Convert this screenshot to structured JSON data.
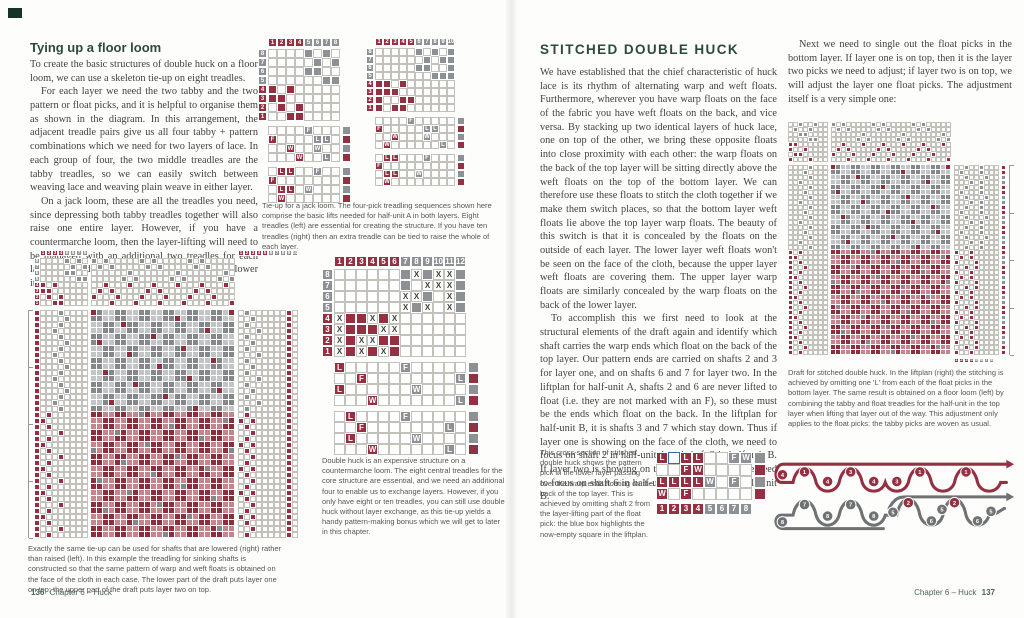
{
  "colors": {
    "accent_red": "#943041",
    "accent_gray": "#8d9194",
    "heading_green": "#2c4a3b",
    "highlight_blue": "#2f6cb0"
  },
  "left_page": {
    "heading": "Tying up a floor loom",
    "paragraphs": [
      "To create the basic structures of double huck on a floor loom, we can use a skeleton tie-up on eight treadles.",
      "For each layer we need the two tabby and the two pattern or float picks, and it is helpful to organise them as shown in the diagram. In this arrangement, the adjacent treadle pairs give us all four tabby + pattern combinations which we need for two layers of lace. In each group of four, the two middle treadles are the tabby treadles, so we can easily switch between weaving lace and weaving plain weave in either layer.",
      "On a jack loom, these are all the treadles you need, since depressing both tabby treadles together will also raise one entire layer. However, if you have a countermarche loom, then the layer-lifting will need to be managed with an additional two treadles for each layer: one tied to raise the layer and one tied to lower it."
    ],
    "caption_tieup": "Tie-up for a jack loom. The four-pick treadling sequences shown here comprise the basic lifts needed for half-unit A in both layers. Eight treadles (left) are essential for creating the structure. If you have ten treadles (right) then an extra treadle can be tied to raise the whole of each layer.",
    "caption_countermarche": "Double huck is an expensive structure on a countermarche loom. The eight central treadles for the core structure are essential, and we need an additional four to enable us to exchange layers. However, if you only have eight or ten treadles, you can still use double huck without layer exchange, as this tie-up yields a handy pattern-making bonus which we will get to later in this chapter.",
    "caption_bottom": "Exactly the same tie-up can be used for shafts that are lowered (right) rather than raised (left). In this example the treadling for sinking shafts is constructed so that the same pattern of warp and weft floats is obtained on the face of the cloth in each case. The lower part of the draft puts layer one on top; the upper part of the draft puts layer two on top.",
    "footer": {
      "page_num": "136",
      "chapter": "Chapter 6 – Huck"
    }
  },
  "right_page": {
    "heading": "STITCHED DOUBLE HUCK",
    "paragraphs": [
      "We have established that the chief characteristic of huck lace is its rhythm of alternating warp and weft floats. Furthermore, wherever you have warp floats on the face of the fabric you have weft floats on the back, and vice versa. By stacking up two identical layers of huck lace, one on top of the other, we bring these opposite floats into close proximity with each other: the warp floats on the back of the top layer will be sitting directly above the weft floats on the top of the bottom layer. We can therefore use these floats to stitch the cloth together if we make them switch places, so that the bottom layer weft floats lie above the top layer warp floats. The beauty of this switch is that it is concealed by the floats on the outside of each layer. The lower layer weft floats won't be seen on the face of the cloth, because the upper layer weft floats are covering them. The upper layer warp floats are similarly concealed by the warp floats on the back of the lower layer.",
      "To accomplish this we first need to look at the structural elements of the draft again and identify which shaft carries the warp ends which float on the back of the top layer. Our pattern ends are carried on shafts 2 and 3 for layer one, and on shafts 6 and 7 for layer two. In the liftplan for half-unit A, shafts 2 and 6 are never lifted to float (i.e. they are not marked with an F), so these must be the ends which float on the back. In the liftplan for half-unit B, it is shafts 3 and 7 which stay down. Thus if layer one is showing on the face of the cloth, we need to focus on shaft 2 in half-unit A and shaft 3 in half-unit B. If layer two is showing on the face of the cloth, we need to focus on shaft 6 in half-unit A and shaft 7 in half-unit B."
    ],
    "col2_paragraph": "Next we need to single out the float picks in the bottom layer. If layer one is on top, then it is the layer two picks we need to adjust; if layer two is on top, we will adjust the layer one float picks. The adjustment itself is a very simple one:",
    "caption_draft": "Draft for stitched double huck. In the liftplan (right) the stitching is achieved by omitting one 'L' from each of the float picks in the bottom layer. The same result is obtained on a floor loom (left) by combining the tabby and float treadles for the half-unit in the top layer when lifting that layer out of the way. This adjustment only applies to the float picks: the tabby picks are woven as usual.",
    "caption_cross_section": "This cross-section of stitched double huck shows the pattern pick in the lower layer passing over the warp ends floating on the back of the top layer. This is achieved by omitting shaft 2 from the layer-lifting part of the float pick: the blue box highlights the now-empty square in the liftplan.",
    "footer": {
      "chapter": "Chapter 6 – Huck",
      "page_num": "137"
    }
  },
  "diagrams": {
    "jack8": {
      "cell": 9,
      "cols": 8,
      "numrow": {
        "labels": [
          "1",
          "2",
          "3",
          "4",
          "5",
          "6",
          "7",
          "8"
        ],
        "colors": "rrrrgggg"
      },
      "shaftcol": {
        "labels": [
          "8",
          "7",
          "6",
          "5",
          "4",
          "3",
          "2",
          "1"
        ],
        "colors": "ggggrrrr"
      },
      "tieup": {
        "rows": [
          "....g.g.",
          ".....g.g",
          "....gg..",
          "......gg",
          "r.r.....",
          "rr......",
          ".r.r....",
          "..rr...."
        ]
      },
      "liftplanA": {
        "rows": [
          "....f...",
          "F....ll.",
          "..W..w..",
          "...W..l."
        ],
        "side": "grgr"
      },
      "liftplanB": {
        "rows": [
          ".LL..f..",
          "F.......",
          ".LL.w...",
          ".W......"
        ],
        "side": "grgr"
      }
    },
    "jack10": {
      "cell": 8,
      "cols": 10,
      "numrow": {
        "labels": [
          "1",
          "2",
          "3",
          "4",
          "5",
          "6",
          "7",
          "8",
          "9",
          "10"
        ],
        "colors": "rrrrrggggg"
      },
      "shaftcol": {
        "labels": [
          "8",
          "7",
          "6",
          "5",
          "4",
          "3",
          "2",
          "1"
        ],
        "colors": "ggggrrrr"
      },
      "tieup": {
        "rows": [
          ".....g.g.g",
          "......g.gg",
          ".....gg..g",
          ".......ggg",
          "rr.r......",
          "rrr.......",
          "r..rr.....",
          "r.rr......"
        ]
      },
      "liftplanA": {
        "rows": [
          "....f.....",
          "F.....ll..",
          "..W...w...",
          ".W......l."
        ],
        "side": "grgr"
      },
      "liftplanB": {
        "rows": [
          ".LL...f...",
          "F.........",
          ".LL..w....",
          ".W........"
        ],
        "side": "grgr"
      }
    },
    "big_left": {
      "cell": 6,
      "numrow": {
        "labels": [
          "1",
          "2",
          "3",
          "4",
          "5",
          "6",
          "7",
          "8"
        ],
        "colors": "rrrrgggg"
      },
      "shaftcol": {
        "labels": [
          "8",
          "7",
          "6",
          "5",
          "4",
          "3",
          "2",
          "1"
        ],
        "colors": "ggggrrrr"
      },
      "tieup": {
        "rows": [
          "....g.g.",
          ".....g.g",
          "....gg..",
          "......gg",
          "r.r.....",
          "rr......",
          ".r.r....",
          "..rr...."
        ]
      },
      "threading": {
        "rows": [
          "g.g.....",
          ".g.g....",
          "......g.",
          ".....g.g",
          "..r...r.",
          ".r.r....",
          "r...r...",
          "...r...r"
        ],
        "repeatX": 3
      },
      "treadling": {
        "sections": [
          {
            "rows": 17,
            "cycle": [
              "r...g....",
              "r....g...",
              "r...g....",
              "r..g....."
            ]
          },
          {
            "rows": 21,
            "cycle": [
              "r.r......",
              "rr.......",
              "r.r......",
              "r...r...."
            ]
          }
        ]
      },
      "drawdown": {
        "cols": 24,
        "cell": 5,
        "sections": [
          {
            "rows": 17,
            "dark": "#84888b",
            "light": "#c2c5c6",
            "accent": "#8e2d3c"
          },
          {
            "rows": 21,
            "dark": "#8e2d3c",
            "light": "#c4858e",
            "accent": "#84888b"
          }
        ]
      },
      "right_numrow": {
        "labels": [
          "1",
          "2",
          "3",
          "4",
          "5",
          "6",
          "7",
          "8",
          "9",
          "10"
        ],
        "colors": "rrrrrggggg"
      },
      "right_grid": {
        "sections": [
          {
            "rows": 17,
            "cycle": [
              ".g......r.",
              "..g.....r.",
              ".g......r.",
              "...g....r."
            ]
          },
          {
            "rows": 21,
            "cycle": [
              ".r......r.",
              "r.r.....r.",
              ".r......r.",
              "..r.....r."
            ]
          }
        ]
      }
    },
    "countermarche12": {
      "cell": 11,
      "numrow": {
        "labels": [
          "1",
          "2",
          "3",
          "4",
          "5",
          "6",
          "7",
          "8",
          "9",
          "10",
          "11",
          "12"
        ],
        "colors": "rrrrrrgggggg"
      },
      "shaftcol": {
        "labels": [
          "8",
          "7",
          "6",
          "5",
          "4",
          "3",
          "2",
          "1"
        ],
        "colors": "ggggrrrr"
      },
      "tieup": {
        "rows": [
          "......gxgxxg",
          "......g.xxxg",
          "......xxg.xg",
          "......xgx.xg",
          "xrrxrx......",
          "xrrrxx......",
          "xrxxrr......",
          "xrxrxr......"
        ]
      },
      "liftplanA": {
        "rows": [
          "L.....f.....",
          "..F........l",
          "L......w....",
          "...W.......l"
        ],
        "side": "grgr"
      },
      "liftplanB": {
        "rows": [
          ".L....f.....",
          "..F.......l.",
          ".L.....w....",
          "...W......l."
        ],
        "side": "grgr"
      }
    },
    "big_right": {
      "cell": 5,
      "tieup": {
        "rows": [
          "..g..g..",
          ".g..g...",
          "..gg....",
          "....gg..",
          "rr......",
          "r..r....",
          ".rr.....",
          "r...r..."
        ]
      },
      "threading": {
        "rows": [
          "g.g.....",
          ".g.g....",
          "......g.",
          ".....g.g",
          "..r...r.",
          ".r.r....",
          "r...r...",
          "...r...r"
        ],
        "repeatX": 3
      },
      "treadling": {
        "sections": [
          {
            "rows": 17,
            "cycle": [
              "....g...",
              "...g....",
              "....g...",
              "..g....."
            ]
          },
          {
            "rows": 21,
            "cycle": [
              "r.r.....",
              "rr......",
              "r.r.....",
              "r..r...."
            ]
          }
        ]
      },
      "drawdown": {
        "cols": 24,
        "cell": 4,
        "sections": [
          {
            "rows": 17,
            "dark": "#84888b",
            "light": "#c2c5c6",
            "accent": "#8e2d3c"
          },
          {
            "rows": 21,
            "dark": "#8e2d3c",
            "light": "#c4858e",
            "accent": "#84888b"
          }
        ]
      },
      "liftplan": {
        "sections": [
          {
            "rows": 17,
            "cycle": [
              "..g..g...",
              ".g...g...",
              "..g...g..",
              "...g.g..."
            ]
          },
          {
            "rows": 21,
            "cycle": [
              "r..r.....",
              ".r.r.....",
              "r...r....",
              "..r.r...."
            ]
          }
        ]
      },
      "pick_strip": {
        "sections": [
          {
            "rows": 38,
            "cycle": [
              "r",
              "r",
              "g",
              "g"
            ]
          }
        ]
      },
      "numrow": {
        "labels": [
          "1",
          "2",
          "3",
          "4",
          "5",
          "6",
          "7",
          "8"
        ],
        "colors": "rrrrgggg"
      }
    },
    "stitch_liftplan": {
      "cell": 12,
      "rows": [
        "LbLL..fw",
        "..FW....",
        "LLLLw.f.",
        "W.F....."
      ],
      "side": "grgr",
      "numrow": {
        "labels": [
          "1",
          "2",
          "3",
          "4",
          "5",
          "6",
          "7",
          "8"
        ],
        "colors": "rrrrgggg"
      }
    },
    "cross_section": {
      "red_circles": [
        {
          "x": 15,
          "y": 22,
          "n": "4"
        },
        {
          "x": 38,
          "y": 19,
          "n": "1"
        },
        {
          "x": 62,
          "y": 29,
          "n": "4"
        },
        {
          "x": 86,
          "y": 19,
          "n": "3"
        },
        {
          "x": 110,
          "y": 29,
          "n": "4"
        },
        {
          "x": 134,
          "y": 29,
          "n": "3"
        },
        {
          "x": 158,
          "y": 19,
          "n": "1"
        },
        {
          "x": 206,
          "y": 19,
          "n": "1"
        },
        {
          "x": 146,
          "y": 51,
          "n": "2"
        },
        {
          "x": 194,
          "y": 51,
          "n": "2"
        }
      ],
      "gray_circles": [
        {
          "x": 15,
          "y": 71,
          "n": "8"
        },
        {
          "x": 38,
          "y": 53,
          "n": "7"
        },
        {
          "x": 62,
          "y": 65,
          "n": "8"
        },
        {
          "x": 86,
          "y": 53,
          "n": "7"
        },
        {
          "x": 110,
          "y": 65,
          "n": "8"
        },
        {
          "x": 130,
          "y": 61,
          "n": "5"
        },
        {
          "x": 170,
          "y": 70,
          "n": "6"
        },
        {
          "x": 181,
          "y": 58,
          "n": "5"
        },
        {
          "x": 218,
          "y": 70,
          "n": "6"
        },
        {
          "x": 232,
          "y": 60,
          "n": "5"
        }
      ]
    }
  }
}
